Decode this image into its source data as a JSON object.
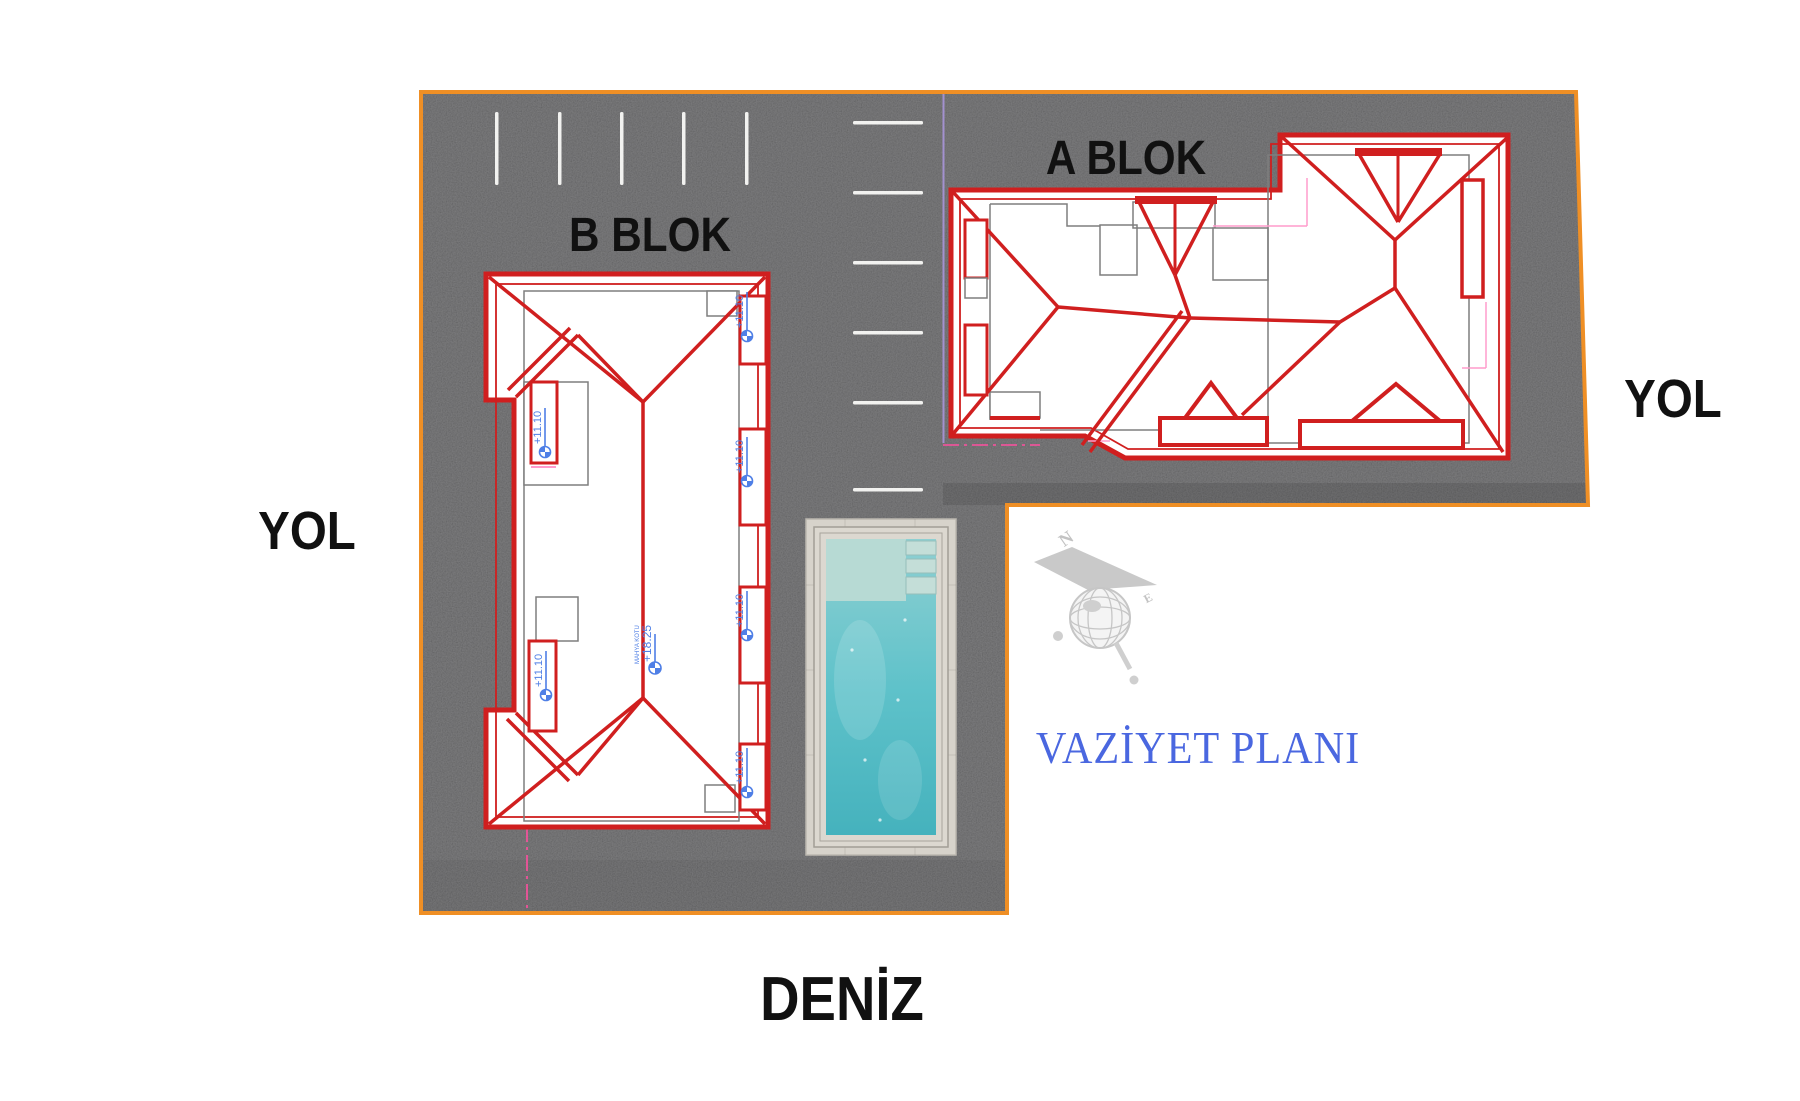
{
  "plan": {
    "title": "VAZİYET PLANI",
    "block_a_label": "A BLOK",
    "block_b_label": "B BLOK",
    "road_left_label": "YOL",
    "road_right_label": "YOL",
    "sea_label": "DENİZ"
  },
  "elevation_markers": {
    "b_right": [
      "+11.10",
      "+11.10",
      "+11.10",
      "+11.10"
    ],
    "b_left": [
      "+11.10",
      "+11.10"
    ],
    "ridge_value": "+18.25",
    "ridge_note": "MAHYA KOTU"
  },
  "compass": {
    "north": "N",
    "east": "E"
  },
  "colors": {
    "boundary_orange": "#ef8f25",
    "asphalt_gray": "#59595b",
    "roof_red": "#d01f1f",
    "footprint_gray": "#7e7e7e",
    "marker_blue": "#4f7fe6",
    "plan_title_blue": "#4a67e0",
    "pool_water_turquoise": "#5fc2ca",
    "pool_stone": "#d7d3cb",
    "setback_pink": "#ff4fa0",
    "parcel_purple": "#a391cf",
    "parking_stripe_white": "#f2f2f0"
  }
}
